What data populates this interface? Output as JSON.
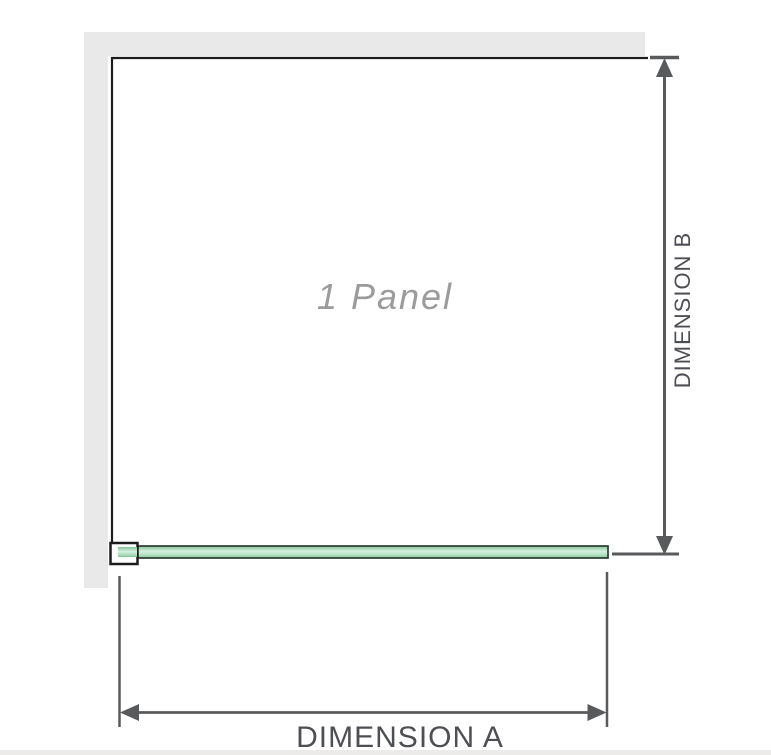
{
  "diagram": {
    "title": "1 Panel shower screen dimension diagram",
    "panel_label": "1 Panel",
    "dimension_a_label": "DIMENSION A",
    "dimension_b_label": "DIMENSION B"
  },
  "icons": {
    "wall": "wall-band",
    "bracket": "wall-bracket",
    "glass": "glass-panel-plan-view",
    "arrows": "double-headed-dimension-arrows"
  },
  "colors": {
    "wall_gray": "#e9e9e9",
    "outline_black": "#1c1c1c",
    "dim_line_gray": "#595a5c",
    "label_gray": "#4e4f54",
    "panel_text_gray": "#9b9b9b",
    "glass_green": "#a9dcba",
    "glass_green_light": "#d6efe0",
    "glass_green_dark": "#7fc493",
    "glass_outline": "#2e3a32",
    "bottom_strip": "#edebe9"
  }
}
